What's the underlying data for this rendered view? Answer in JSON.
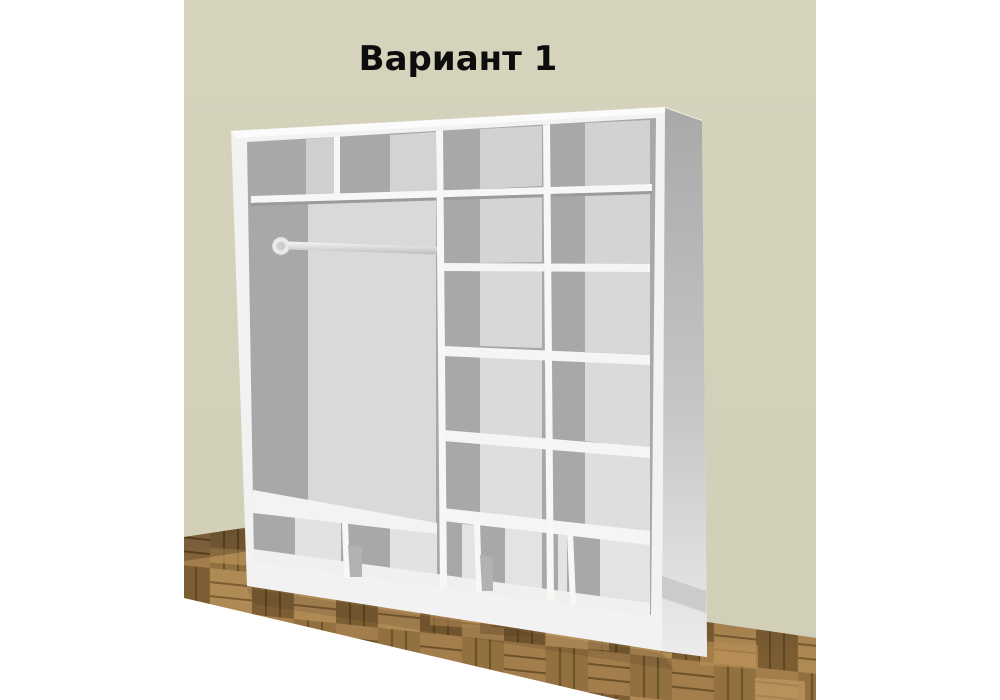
{
  "title": "Вариант 1",
  "scene": {
    "background": "#ffffff",
    "wall_color": "#d4d1ba",
    "floor_base": "#8a6a3e",
    "floor_light": "#b28a55",
    "floor_dark": "#664d29",
    "cabinet_body": "#f2f2f2",
    "cabinet_interior_shadow": "#a8a8a8",
    "cabinet_back_panel": "#d9d9d7",
    "title_color": "#0d0d0d"
  },
  "wardrobe": {
    "sections": [
      {
        "id": "left-hanging-section",
        "top_cells": 2,
        "has_top_shelf": true,
        "has_hanging_rod": true,
        "has_bottom_shelf": true,
        "bottom_cells": 2
      },
      {
        "id": "middle-shelf-column",
        "shelves": 5,
        "rows": 6,
        "bottom_row_divided": true
      },
      {
        "id": "right-shelf-column",
        "shelves": 5,
        "rows": 6,
        "bottom_row_divided": true
      }
    ],
    "total_compartments": 19
  }
}
